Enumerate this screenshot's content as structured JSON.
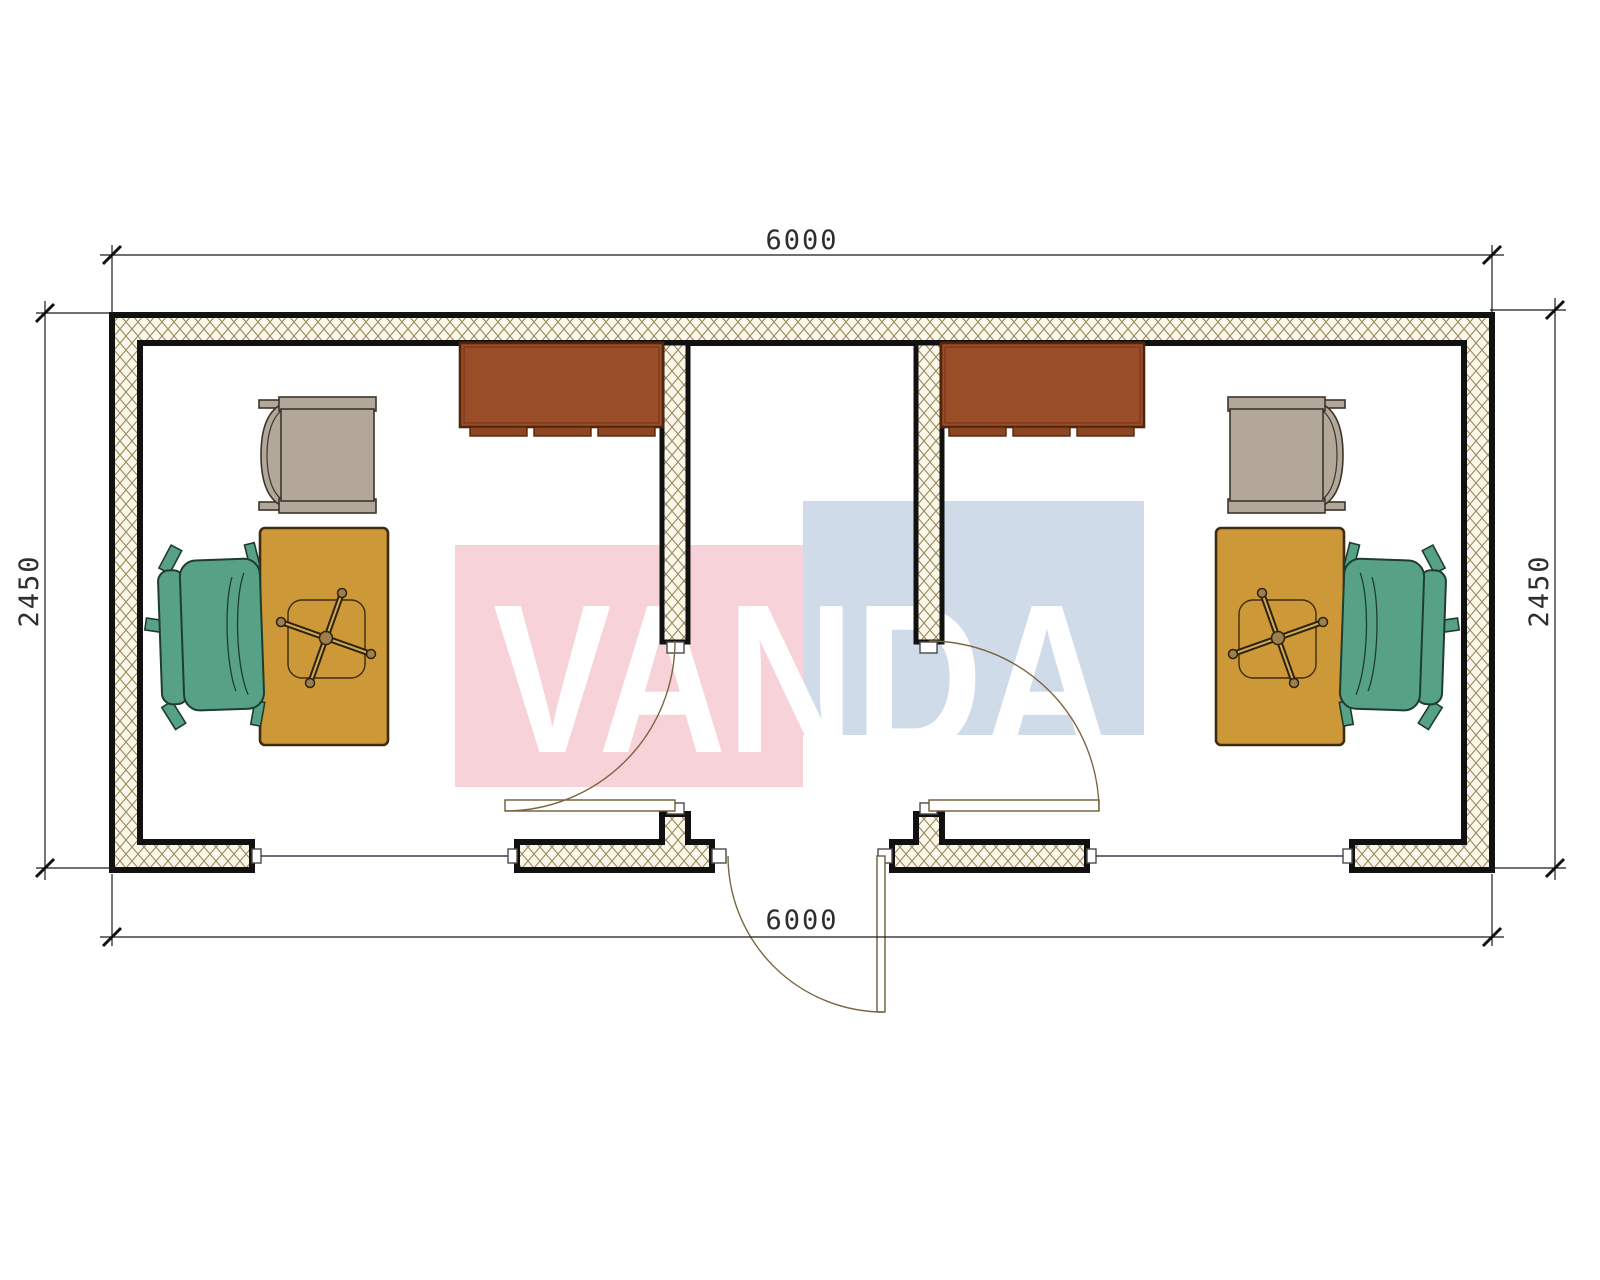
{
  "document": {
    "type": "architectural-floor-plan",
    "description": "Plan of a 6000 x 2450 container cabin with two offices and central entrance vestibule"
  },
  "watermark": {
    "text": "VANDA",
    "text_color": "#ffffff",
    "pink_block_color": "#f7d2d9",
    "blue_block_color": "#cfdbe8"
  },
  "dimensions": {
    "width_top": "6000",
    "width_bottom": "6000",
    "height_left": "2450",
    "height_right": "2450"
  },
  "colors": {
    "wall_line": "#111111",
    "wall_hatch_line": "#9a8c5e",
    "wall_fill": "#fbf6ea",
    "door_swing_line": "#7a6542",
    "window_line": "#3c3c55",
    "desk_fill": "#cc9838",
    "desk_outline": "#3f2c10",
    "cabinet_fill": "#9a4e28",
    "cabinet_foot_fill": "#8d4522",
    "cabinet_outline": "#50250e",
    "office_chair_fill": "#57a287",
    "office_chair_outline": "#1e3d2e",
    "armchair_fill": "#b3a79a",
    "armchair_outline": "#3a352c",
    "chair_base_line": "#2e2209",
    "chair_base_highlight": "#cfa95c",
    "dimension_text": "#2e2e2e"
  }
}
